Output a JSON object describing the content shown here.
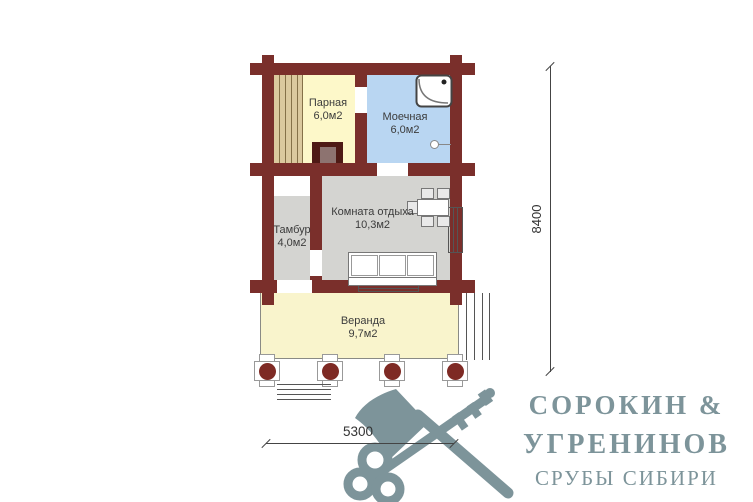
{
  "plan": {
    "rooms": {
      "parnaya": {
        "name": "Парная",
        "area": "6,0м2"
      },
      "moechnaya": {
        "name": "Моечная",
        "area": "6,0м2"
      },
      "tambur": {
        "name": "Тамбур",
        "area": "4,0м2"
      },
      "komnata": {
        "name": "Комната отдыха",
        "area": "10,3м2"
      },
      "veranda": {
        "name": "Веранда",
        "area": "9,7м2"
      }
    },
    "dimensions": {
      "vertical": "8400",
      "horizontal": "5300"
    }
  },
  "logo": {
    "line1": "СОРОКИН &",
    "line2": "УГРЕНИНОВ",
    "line3": "СРУБЫ СИБИРИ",
    "icon": "axe-and-key"
  },
  "colors": {
    "wall": "#7a2f2b",
    "parnaya_fill": "#fdf8c9",
    "moechnaya_fill": "#b9d6f2",
    "gray_fill": "#d4d4d1",
    "veranda_fill": "#f9f4cc",
    "bench": "#dbc99e",
    "column_dot": "#7e2a24",
    "logo": "#7d949a"
  }
}
